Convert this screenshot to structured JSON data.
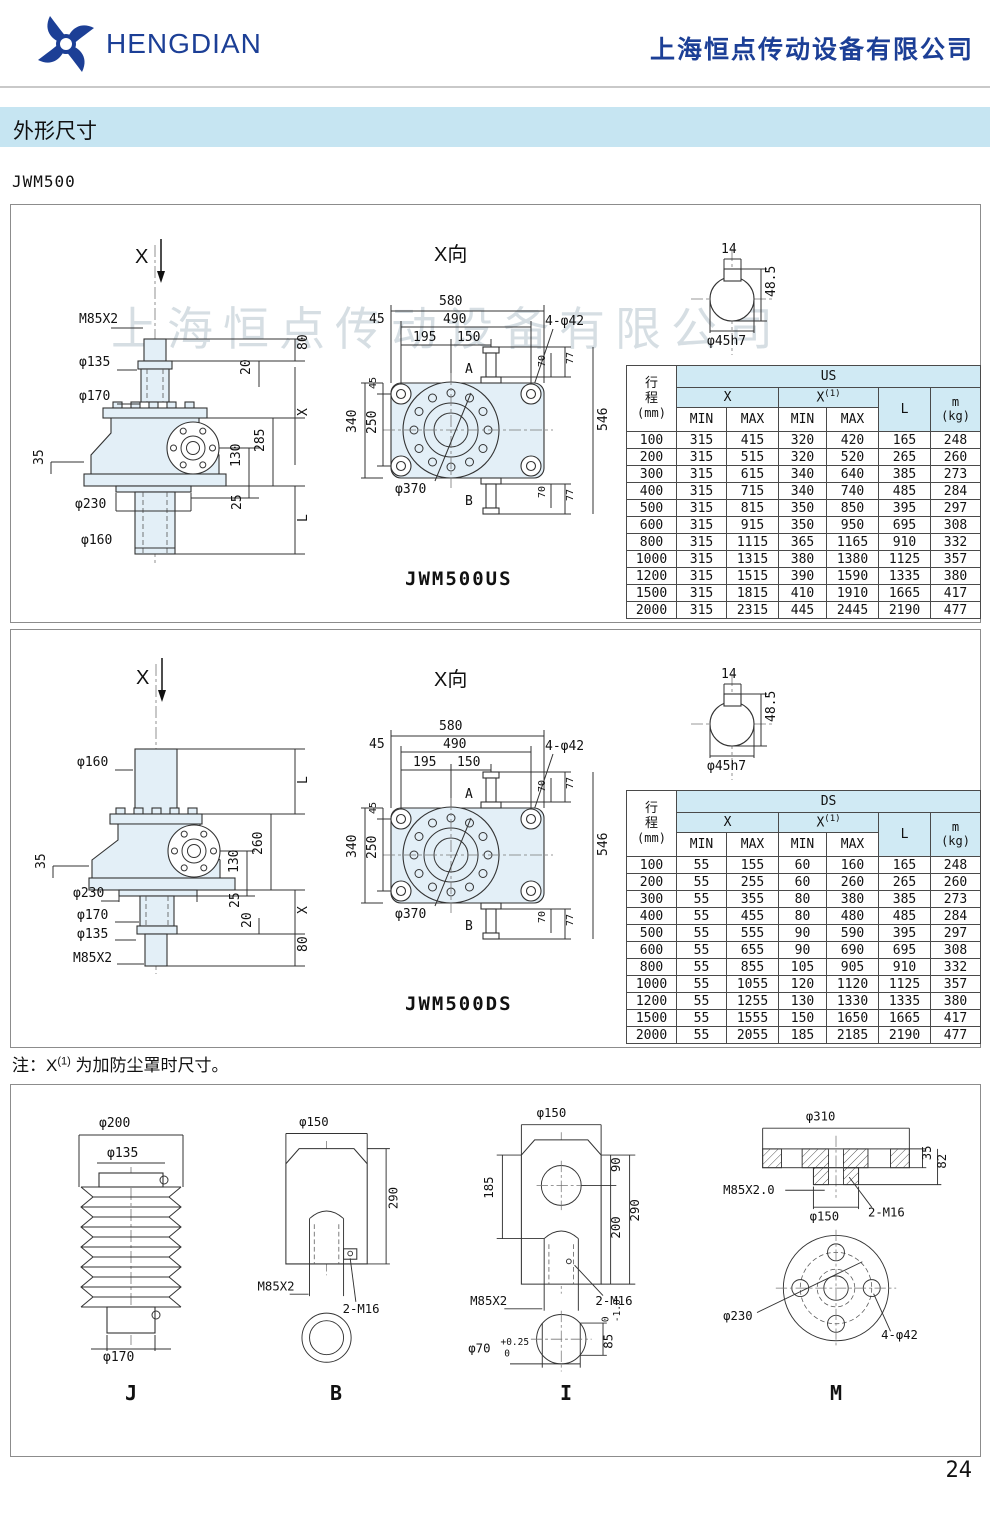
{
  "header": {
    "brand": "HENGDIAN",
    "company": "上海恒点传动设备有限公司"
  },
  "section_title": "外形尺寸",
  "model": "JWM500",
  "watermark": "上海恒点传动设备有限公司",
  "note": {
    "prefix": "注：X",
    "sup": "(1)",
    "suffix": "为加防尘罩时尺寸。"
  },
  "page_number": "24",
  "colors": {
    "brand_blue": "#1c3f96",
    "banner_bg": "#c6e5f2",
    "table_header_bg": "#d0eaf4"
  },
  "table_headers": {
    "stroke": "行程",
    "unit": "(mm)",
    "x": "X",
    "xsup": "(1)",
    "min": "MIN",
    "max": "MAX",
    "l": "L",
    "m": "m",
    "kg": "(kg)"
  },
  "us": {
    "caption": "JWM500US",
    "group": "US",
    "side": {
      "x": "X",
      "m85": "M85X2",
      "d135": "φ135",
      "d170": "φ170",
      "d230": "φ230",
      "d160": "φ160",
      "t35": "35",
      "t80": "80",
      "t20": "20",
      "tx": "X",
      "t285": "285",
      "t130": "130",
      "t25": "25",
      "tl": "L"
    },
    "rows": [
      [
        "100",
        "315",
        "415",
        "320",
        "420",
        "165",
        "248"
      ],
      [
        "200",
        "315",
        "515",
        "320",
        "520",
        "265",
        "260"
      ],
      [
        "300",
        "315",
        "615",
        "340",
        "640",
        "385",
        "273"
      ],
      [
        "400",
        "315",
        "715",
        "340",
        "740",
        "485",
        "284"
      ],
      [
        "500",
        "315",
        "815",
        "350",
        "850",
        "395",
        "297"
      ],
      [
        "600",
        "315",
        "915",
        "350",
        "950",
        "695",
        "308"
      ],
      [
        "800",
        "315",
        "1115",
        "365",
        "1165",
        "910",
        "332"
      ],
      [
        "1000",
        "315",
        "1315",
        "380",
        "1380",
        "1125",
        "357"
      ],
      [
        "1200",
        "315",
        "1515",
        "390",
        "1590",
        "1335",
        "380"
      ],
      [
        "1500",
        "315",
        "1815",
        "410",
        "1910",
        "1665",
        "417"
      ],
      [
        "2000",
        "315",
        "2315",
        "445",
        "2445",
        "2190",
        "477"
      ]
    ]
  },
  "ds": {
    "caption": "JWM500DS",
    "group": "DS",
    "side": {
      "x": "X",
      "d160": "φ160",
      "tl": "L",
      "t260": "260",
      "t130": "130",
      "t35": "35",
      "d230": "φ230",
      "t25": "25",
      "tx": "X",
      "d170": "φ170",
      "t20": "20",
      "d135": "φ135",
      "m85": "M85X2",
      "t80": "80"
    },
    "rows": [
      [
        "100",
        "55",
        "155",
        "60",
        "160",
        "165",
        "248"
      ],
      [
        "200",
        "55",
        "255",
        "60",
        "260",
        "265",
        "260"
      ],
      [
        "300",
        "55",
        "355",
        "80",
        "380",
        "385",
        "273"
      ],
      [
        "400",
        "55",
        "455",
        "80",
        "480",
        "485",
        "284"
      ],
      [
        "500",
        "55",
        "555",
        "90",
        "590",
        "395",
        "297"
      ],
      [
        "600",
        "55",
        "655",
        "90",
        "690",
        "695",
        "308"
      ],
      [
        "800",
        "55",
        "855",
        "105",
        "905",
        "910",
        "332"
      ],
      [
        "1000",
        "55",
        "1055",
        "120",
        "1120",
        "1125",
        "357"
      ],
      [
        "1200",
        "55",
        "1255",
        "130",
        "1330",
        "1335",
        "380"
      ],
      [
        "1500",
        "55",
        "1555",
        "150",
        "1650",
        "1665",
        "417"
      ],
      [
        "2000",
        "55",
        "2055",
        "185",
        "2185",
        "2190",
        "477"
      ]
    ]
  },
  "top_view": {
    "title": "X向",
    "t580": "580",
    "t490": "490",
    "t45": "45",
    "t195": "195",
    "t150": "150",
    "holes": "4-φ42",
    "c45": "45",
    "t340": "340",
    "t250": "250",
    "d370": "φ370",
    "t546": "546",
    "a": "A",
    "b": "B",
    "t70": "70",
    "t77": "77"
  },
  "shaft_view": {
    "t14": "14",
    "t485": "48.5",
    "d45": "φ45h7"
  },
  "accessories": {
    "j": {
      "label": "J",
      "d200": "φ200",
      "d135": "φ135",
      "d170": "φ170"
    },
    "b": {
      "label": "B",
      "d150": "φ150",
      "t290": "290",
      "m85": "M85X2",
      "m16": "2-M16"
    },
    "i": {
      "label": "I",
      "d150": "φ150",
      "t185": "185",
      "t90": "90",
      "t200": "200",
      "t290": "290",
      "m85": "M85X2",
      "m16": "2-M16",
      "d70": "φ70",
      "d70sup": "+0.25",
      "d70sub": "0",
      "t85": "85",
      "t85sup": "0",
      "t85sub": "-1.0"
    },
    "m": {
      "label": "M",
      "d310": "φ310",
      "t35": "35",
      "t82": "82",
      "m85": "M85X2.0",
      "d150": "φ150",
      "m16": "2-M16",
      "d230": "φ230",
      "holes": "4-φ42"
    }
  }
}
